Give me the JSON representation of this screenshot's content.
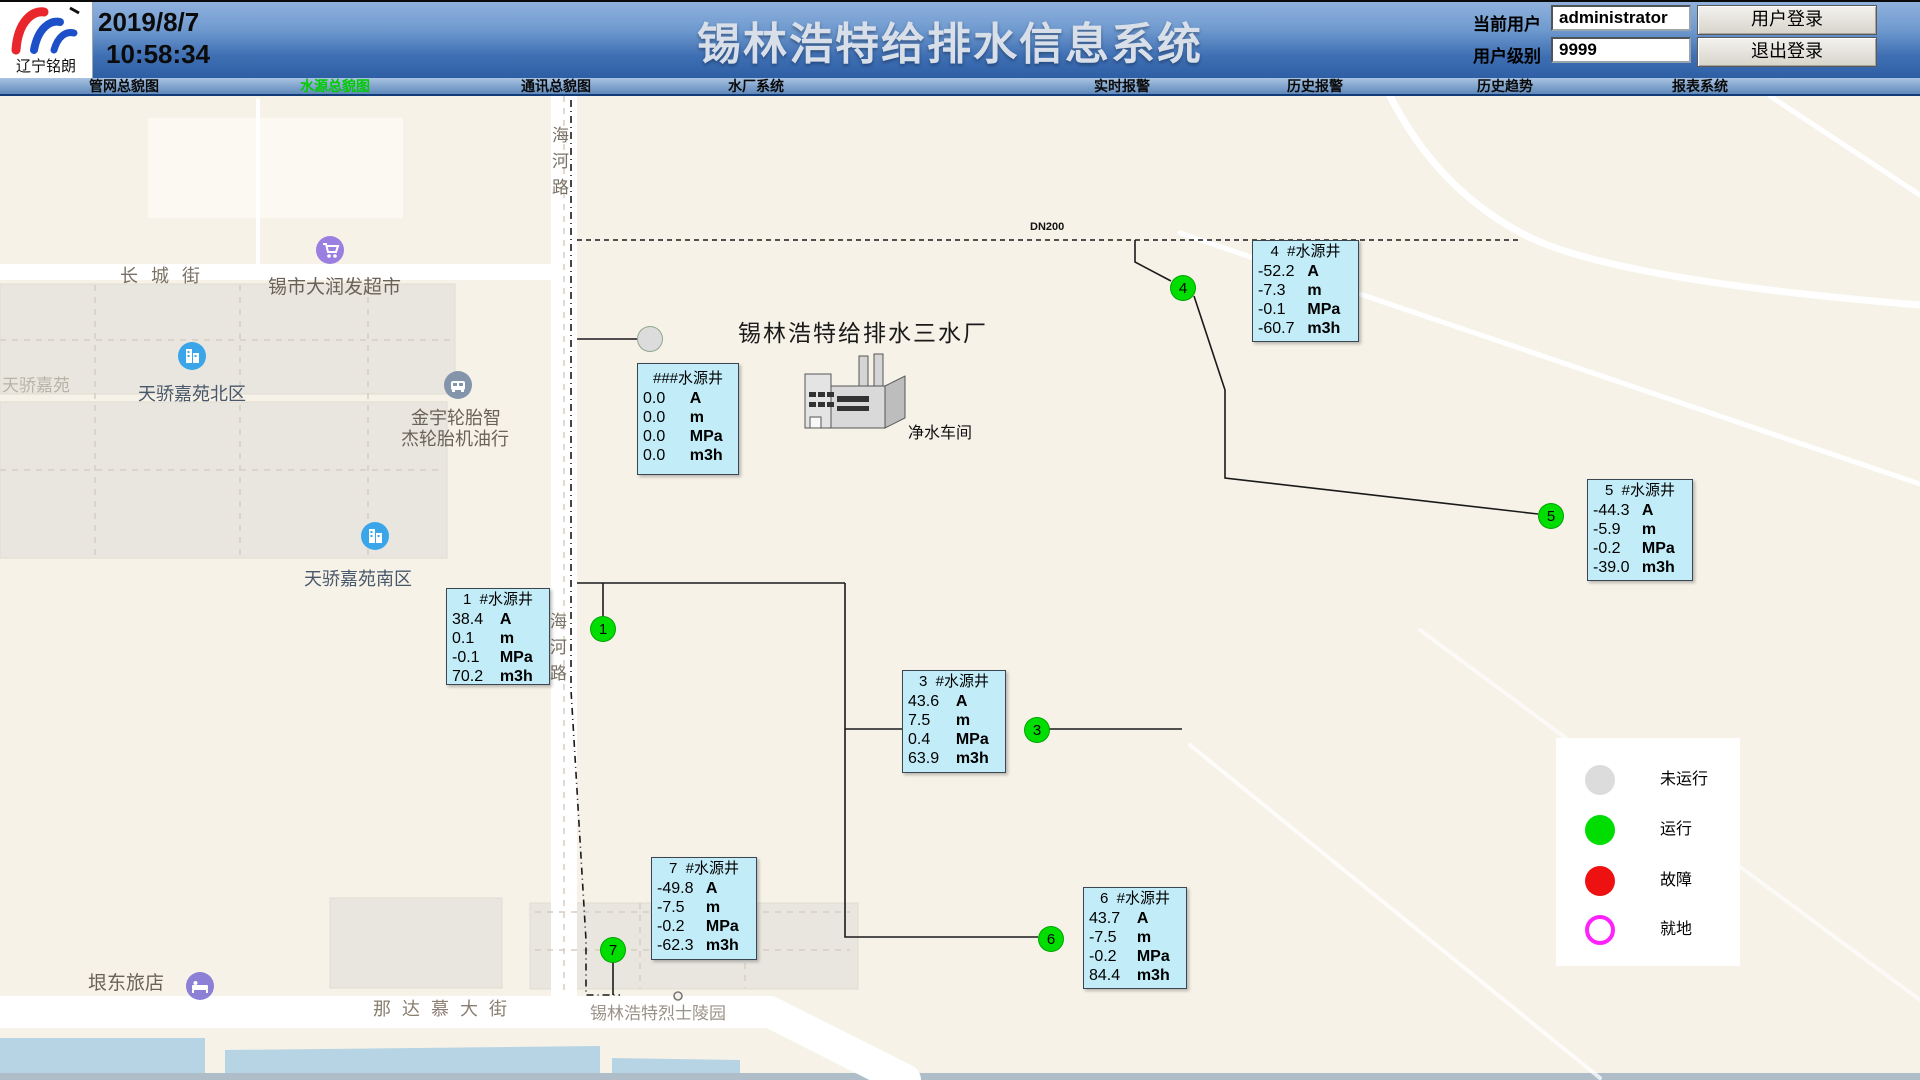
{
  "header": {
    "company": "辽宁铭朗",
    "date": "2019/8/7",
    "time": "10:58:34",
    "title": "锡林浩特给排水信息系统",
    "user_label": "当前用户",
    "user_value": "administrator",
    "level_label": "用户级别",
    "level_value": "9999",
    "login_button": "用户登录",
    "logout_button": "退出登录"
  },
  "nav": {
    "active_color": "#00cc00",
    "tabs": [
      {
        "label": "管网总貌图",
        "active": false
      },
      {
        "label": "水源总貌图",
        "active": true
      },
      {
        "label": "通讯总貌图",
        "active": false
      },
      {
        "label": "水厂系统",
        "active": false
      },
      {
        "label": "实时报警",
        "active": false
      },
      {
        "label": "历史报警",
        "active": false
      },
      {
        "label": "历史趋势",
        "active": false
      },
      {
        "label": "报表系统",
        "active": false
      }
    ]
  },
  "map": {
    "colors": {
      "running": "#00dd00",
      "stopped": "#dcdcdc",
      "fault": "#ee1111",
      "local": "#ff22ff",
      "box_bg": "#c2edf8",
      "water": "#b7d4e4"
    },
    "places": {
      "changchengjie": "长 城 街",
      "supermarket": "锡市大润发超市",
      "tianjiao": "天骄嘉苑",
      "tianjiao_north": "天骄嘉苑北区",
      "jinyu1": "金宇轮胎智",
      "jinyu2": "杰轮胎机油行",
      "tianjiao_south": "天骄嘉苑南区",
      "hotel": "垠东旅店",
      "nadamu": "那 达 慕 大 街",
      "martyrs": "锡林浩特烈士陵园",
      "haihe": "海河路",
      "plant_title": "锡林浩特给排水三水厂",
      "workshop": "净水车间",
      "pipe_label": "DN200"
    },
    "wells": [
      {
        "circle": "",
        "title": "###水源井",
        "color": "#dcdcdc",
        "rows": [
          {
            "value": "0.0",
            "unit": "A"
          },
          {
            "value": "0.0",
            "unit": "m"
          },
          {
            "value": "0.0",
            "unit": "MPa"
          },
          {
            "value": "0.0",
            "unit": "m3h"
          }
        ]
      },
      {
        "circle": "1",
        "title": "1  #水源井",
        "color": "#00dd00",
        "rows": [
          {
            "value": "38.4",
            "unit": "A"
          },
          {
            "value": "0.1",
            "unit": "m"
          },
          {
            "value": "-0.1",
            "unit": "MPa"
          },
          {
            "value": "70.2",
            "unit": "m3h"
          }
        ]
      },
      {
        "circle": "3",
        "title": "3  #水源井",
        "color": "#00dd00",
        "rows": [
          {
            "value": "43.6",
            "unit": "A"
          },
          {
            "value": "7.5",
            "unit": "m"
          },
          {
            "value": "0.4",
            "unit": "MPa"
          },
          {
            "value": "63.9",
            "unit": "m3h"
          }
        ]
      },
      {
        "circle": "4",
        "title": "4  #水源井",
        "color": "#00dd00",
        "rows": [
          {
            "value": "-52.2",
            "unit": "A"
          },
          {
            "value": "-7.3",
            "unit": "m"
          },
          {
            "value": "-0.1",
            "unit": "MPa"
          },
          {
            "value": "-60.7",
            "unit": "m3h"
          }
        ]
      },
      {
        "circle": "5",
        "title": "5  #水源井",
        "color": "#00dd00",
        "rows": [
          {
            "value": "-44.3",
            "unit": "A"
          },
          {
            "value": "-5.9",
            "unit": "m"
          },
          {
            "value": "-0.2",
            "unit": "MPa"
          },
          {
            "value": "-39.0",
            "unit": "m3h"
          }
        ]
      },
      {
        "circle": "6",
        "title": "6  #水源井",
        "color": "#00dd00",
        "rows": [
          {
            "value": "43.7",
            "unit": "A"
          },
          {
            "value": "-7.5",
            "unit": "m"
          },
          {
            "value": "-0.2",
            "unit": "MPa"
          },
          {
            "value": "84.4",
            "unit": "m3h"
          }
        ]
      },
      {
        "circle": "7",
        "title": "7  #水源井",
        "color": "#00dd00",
        "rows": [
          {
            "value": "-49.8",
            "unit": "A"
          },
          {
            "value": "-7.5",
            "unit": "m"
          },
          {
            "value": "-0.2",
            "unit": "MPa"
          },
          {
            "value": "-62.3",
            "unit": "m3h"
          }
        ]
      }
    ],
    "legend": {
      "items": [
        {
          "label": "未运行",
          "color": "#dcdcdc"
        },
        {
          "label": "运行",
          "color": "#00dd00"
        },
        {
          "label": "故障",
          "color": "#ee1111"
        },
        {
          "label": "就地",
          "color": "#ff22ff"
        }
      ]
    }
  }
}
